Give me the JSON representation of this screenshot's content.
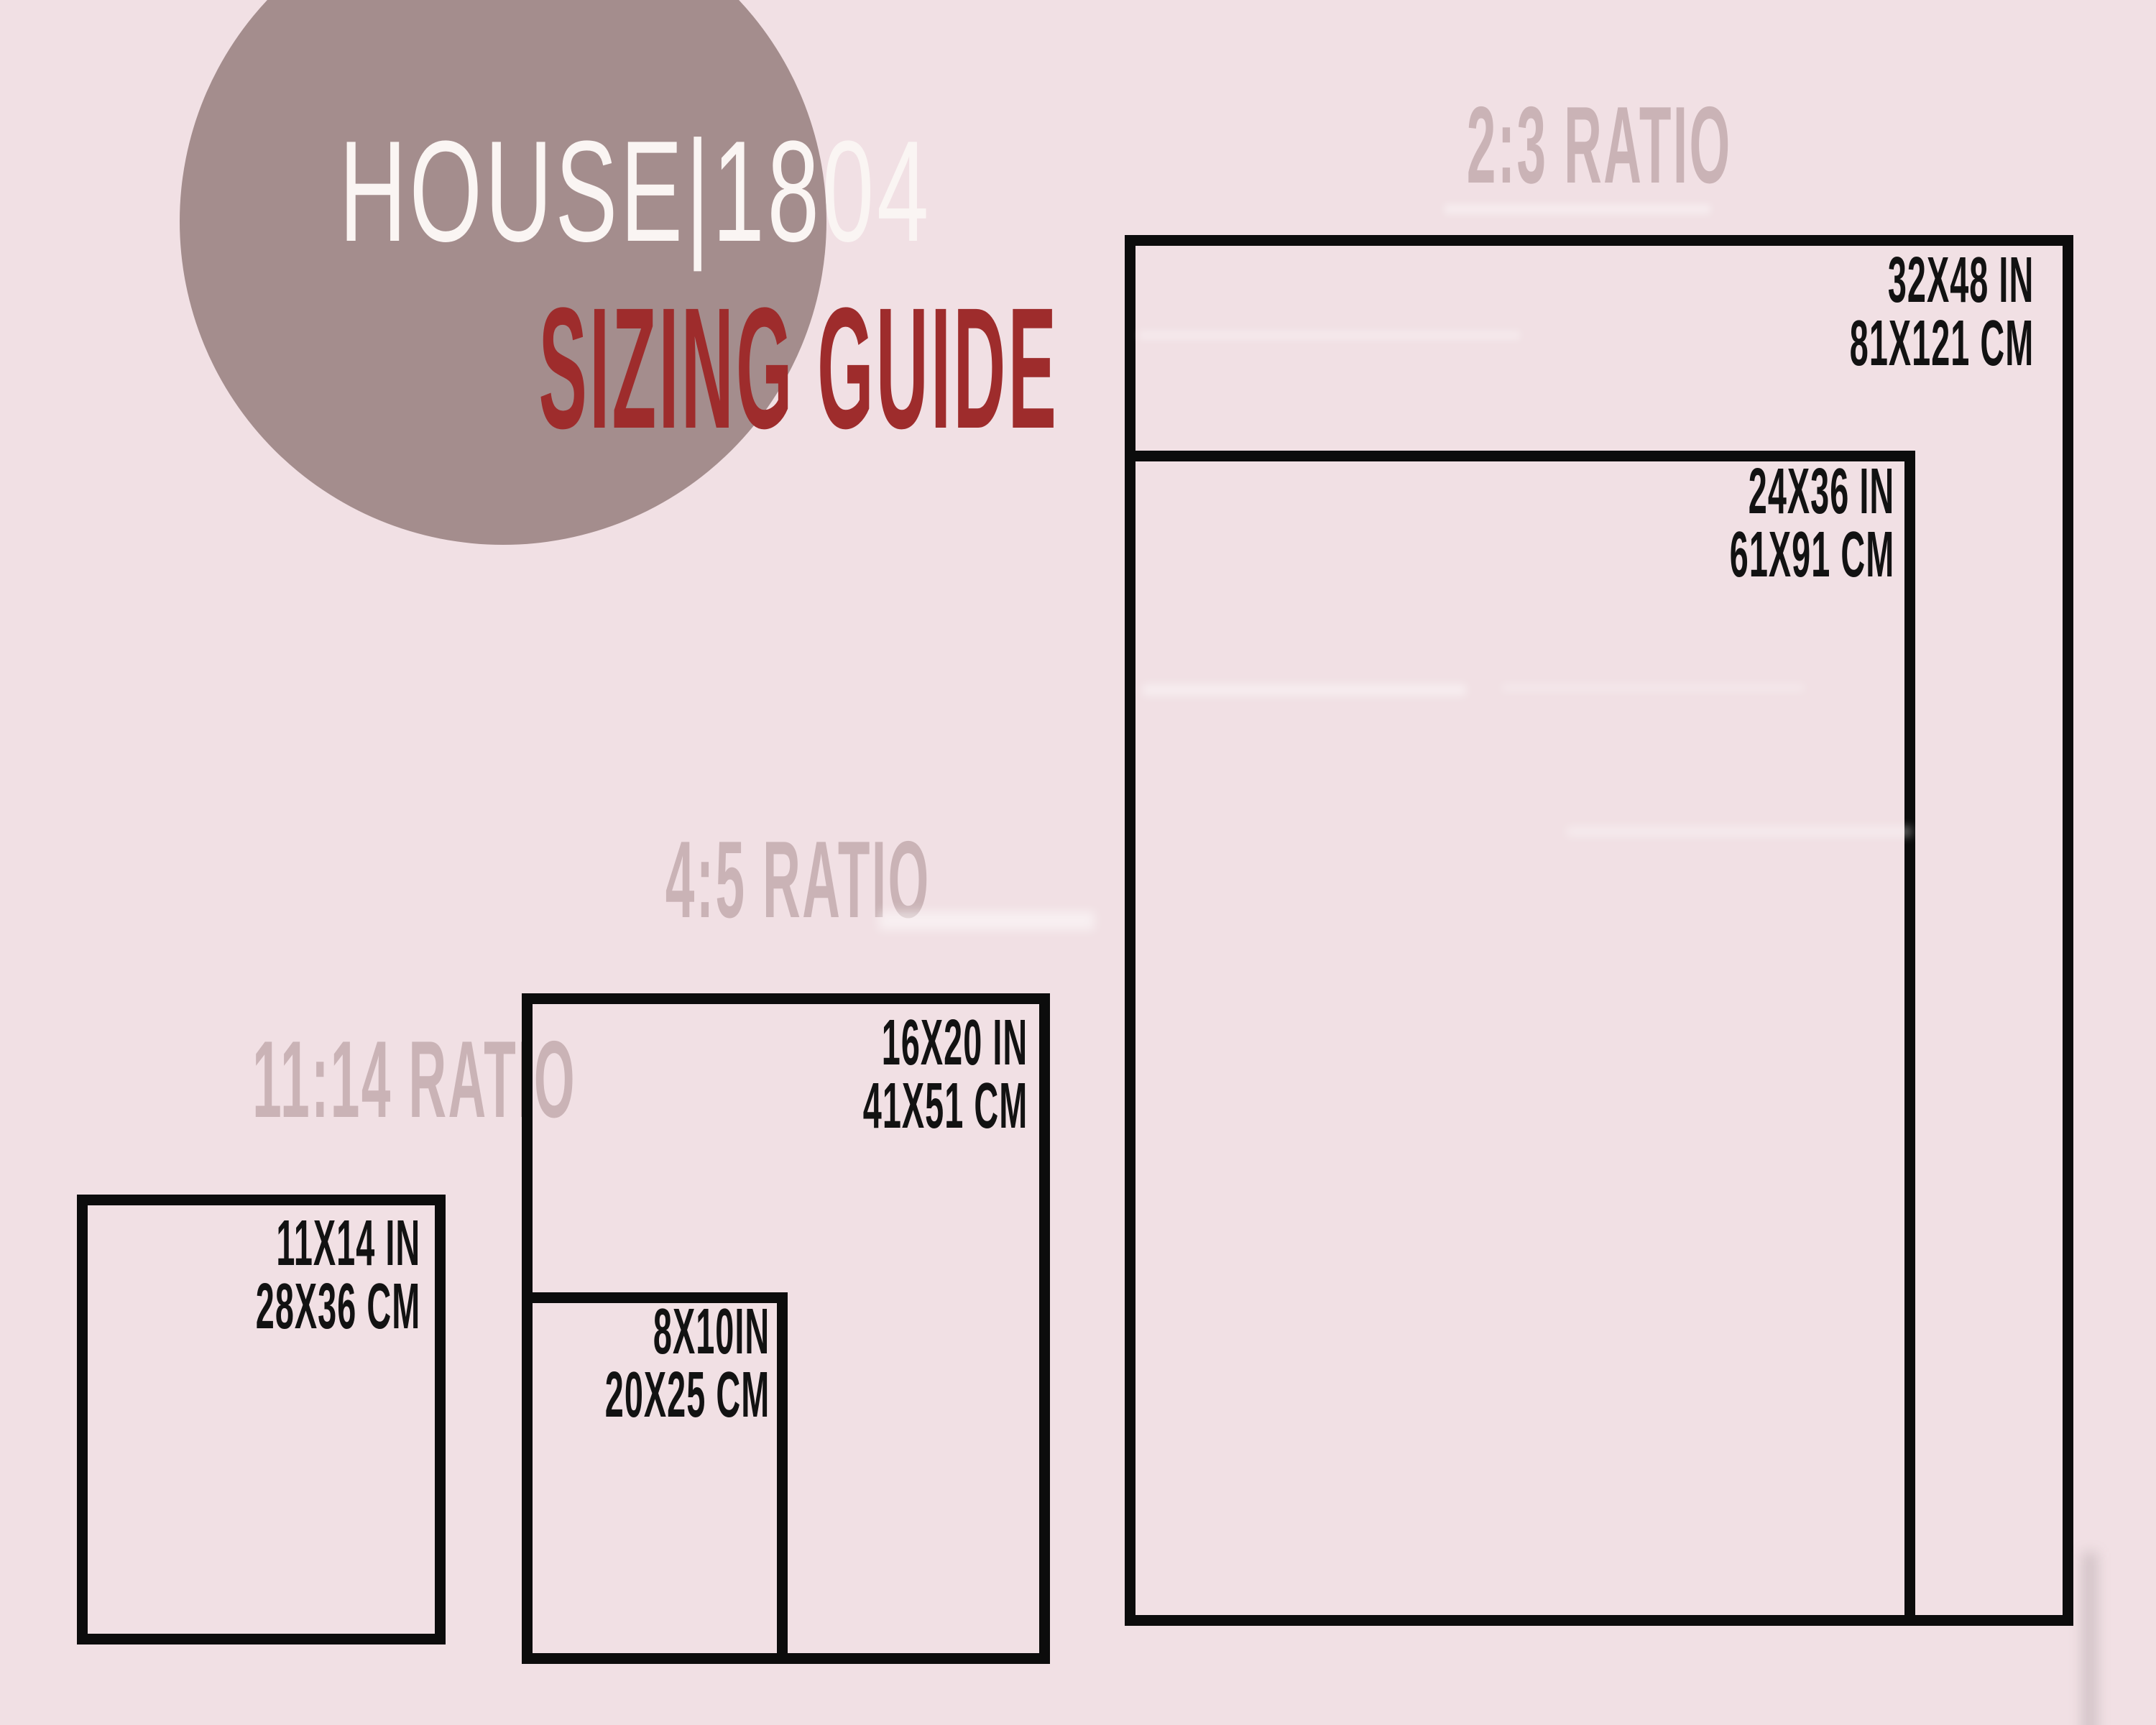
{
  "poster": {
    "logo": {
      "brand": "HOUSE|1804",
      "subtitle": "SIZING GUIDE"
    },
    "sections": [
      {
        "ratio_label": "2:3 RATIO",
        "sizes": [
          {
            "inches": "32X48 IN",
            "cm": "81X121 CM"
          },
          {
            "inches": "24X36 IN",
            "cm": "61X91 CM"
          }
        ]
      },
      {
        "ratio_label": "4:5 RATIO",
        "sizes": [
          {
            "inches": "16X20 IN",
            "cm": "41X51 CM"
          },
          {
            "inches": "8X10IN",
            "cm": "20X25 CM"
          }
        ]
      },
      {
        "ratio_label": "11:14 RATIO",
        "sizes": [
          {
            "inches": "11X14 IN",
            "cm": "28X36 CM"
          }
        ]
      }
    ]
  },
  "colors": {
    "background": "#f1e0e4",
    "panel-outline": "#0c0c0c",
    "circle": "#a48d8d",
    "brand-text": "#faf5f3",
    "accent-red": "#9e2c2c",
    "ratio-heading": "#cab3b6",
    "label-ink": "#121212"
  }
}
